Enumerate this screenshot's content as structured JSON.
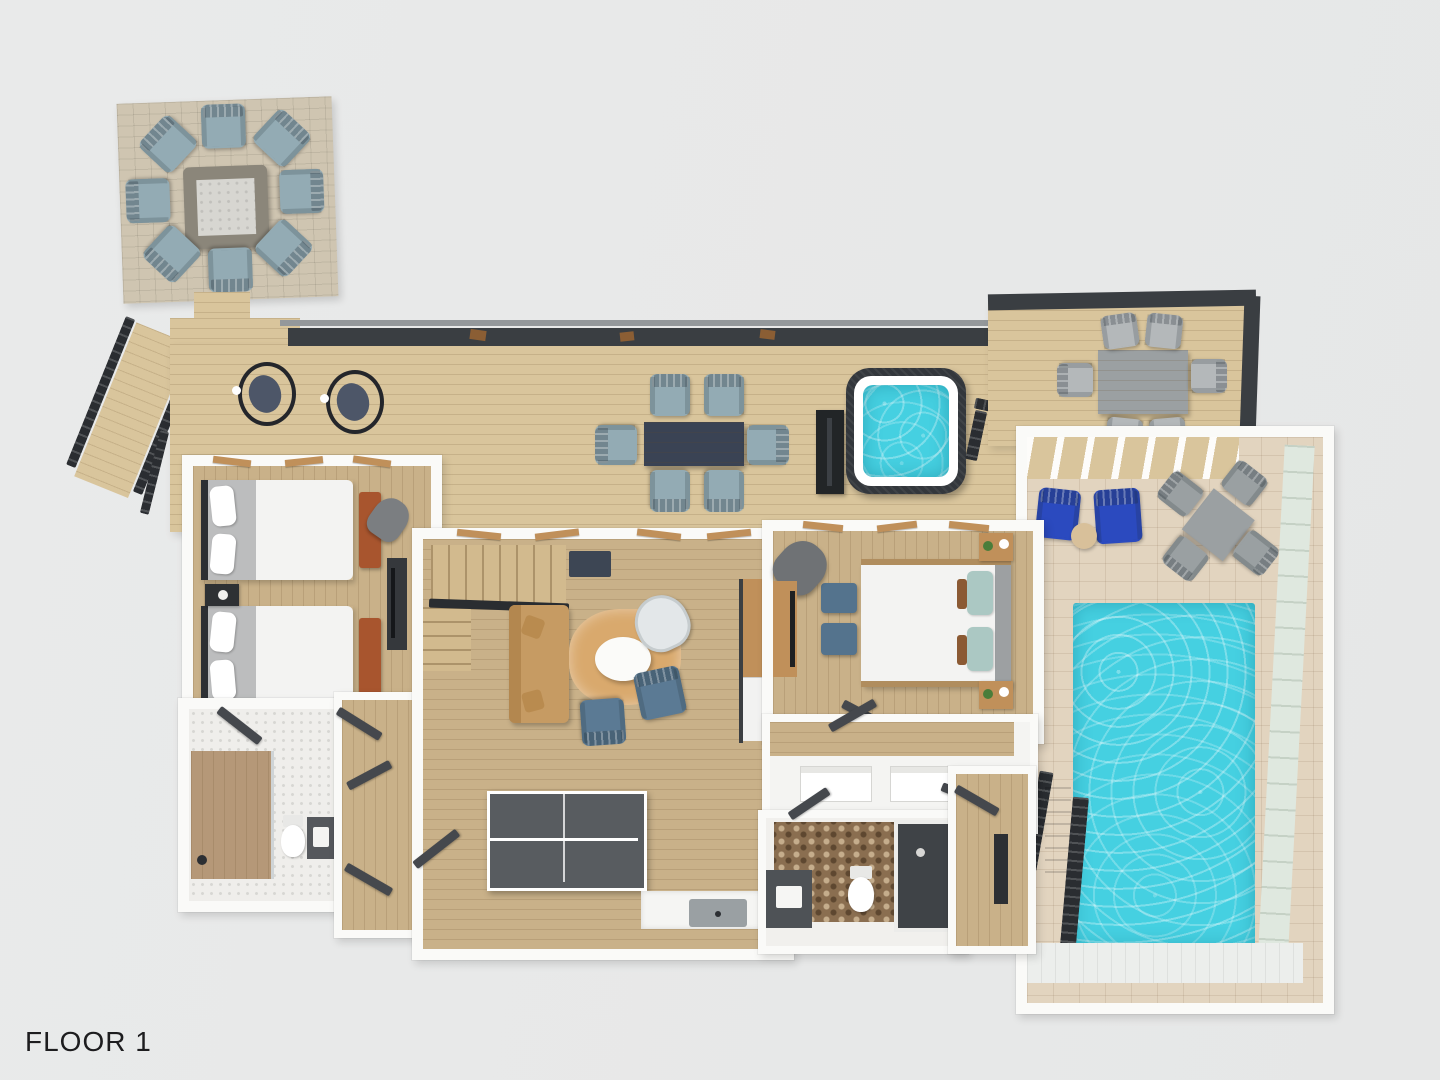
{
  "label": {
    "floor": "FLOOR 1"
  },
  "palette": {
    "bg": "#e9eaea",
    "wall": "#fafaf8",
    "roof-dark": "#3a3e42",
    "metal-dark": "#2a2d31",
    "deck-wood": "#d9c59c",
    "floor-wood": "#c9b189",
    "stone-paver": "#cfc5b1",
    "firepit-stone": "#8b867a",
    "firepit-gravel": "#d7d6d1",
    "chair-blue": "#93abb4",
    "chair-gray": "#b4b8ba",
    "table-navy": "#3a4354",
    "hot-tub-shell": "#33373c",
    "water": "#45d0e1",
    "pool-tile": "#e2d4bf",
    "glass-green": "#dfe8df",
    "royal-blue": "#2b4abf",
    "patio-gray": "#9ba0a2",
    "sofa-tan": "#c69b63",
    "rug-tan": "#d9a96d",
    "slate-chair": "#5b7a94",
    "gray-chair": "#7b7e81",
    "bed-white": "#f3f3f2",
    "bed-gray": "#bcbdbe",
    "wood-accent": "#c0905a",
    "bench-rust": "#a8552e",
    "console-dark": "#35383c",
    "pingpong": "#585c60",
    "hex-brown": "#8a6e50",
    "tile-white": "#efeeeb",
    "marble": "#f5f5f3",
    "teal-pillow": "#abc8c3",
    "white-deck": "#eceeec",
    "text": "#1d1d1f"
  },
  "inventory": {
    "fire_pit_chairs": 8,
    "hanging_egg_chairs": 2,
    "deck_dining_seats": 6,
    "side_deck_dining_seats": 6,
    "pool_patio_lounge_chairs": 2,
    "pool_patio_dining_seats": 4,
    "beds": 3,
    "bathrooms": 2,
    "hot_tubs": 1,
    "swimming_pools": 1,
    "ping_pong_tables": 1
  }
}
